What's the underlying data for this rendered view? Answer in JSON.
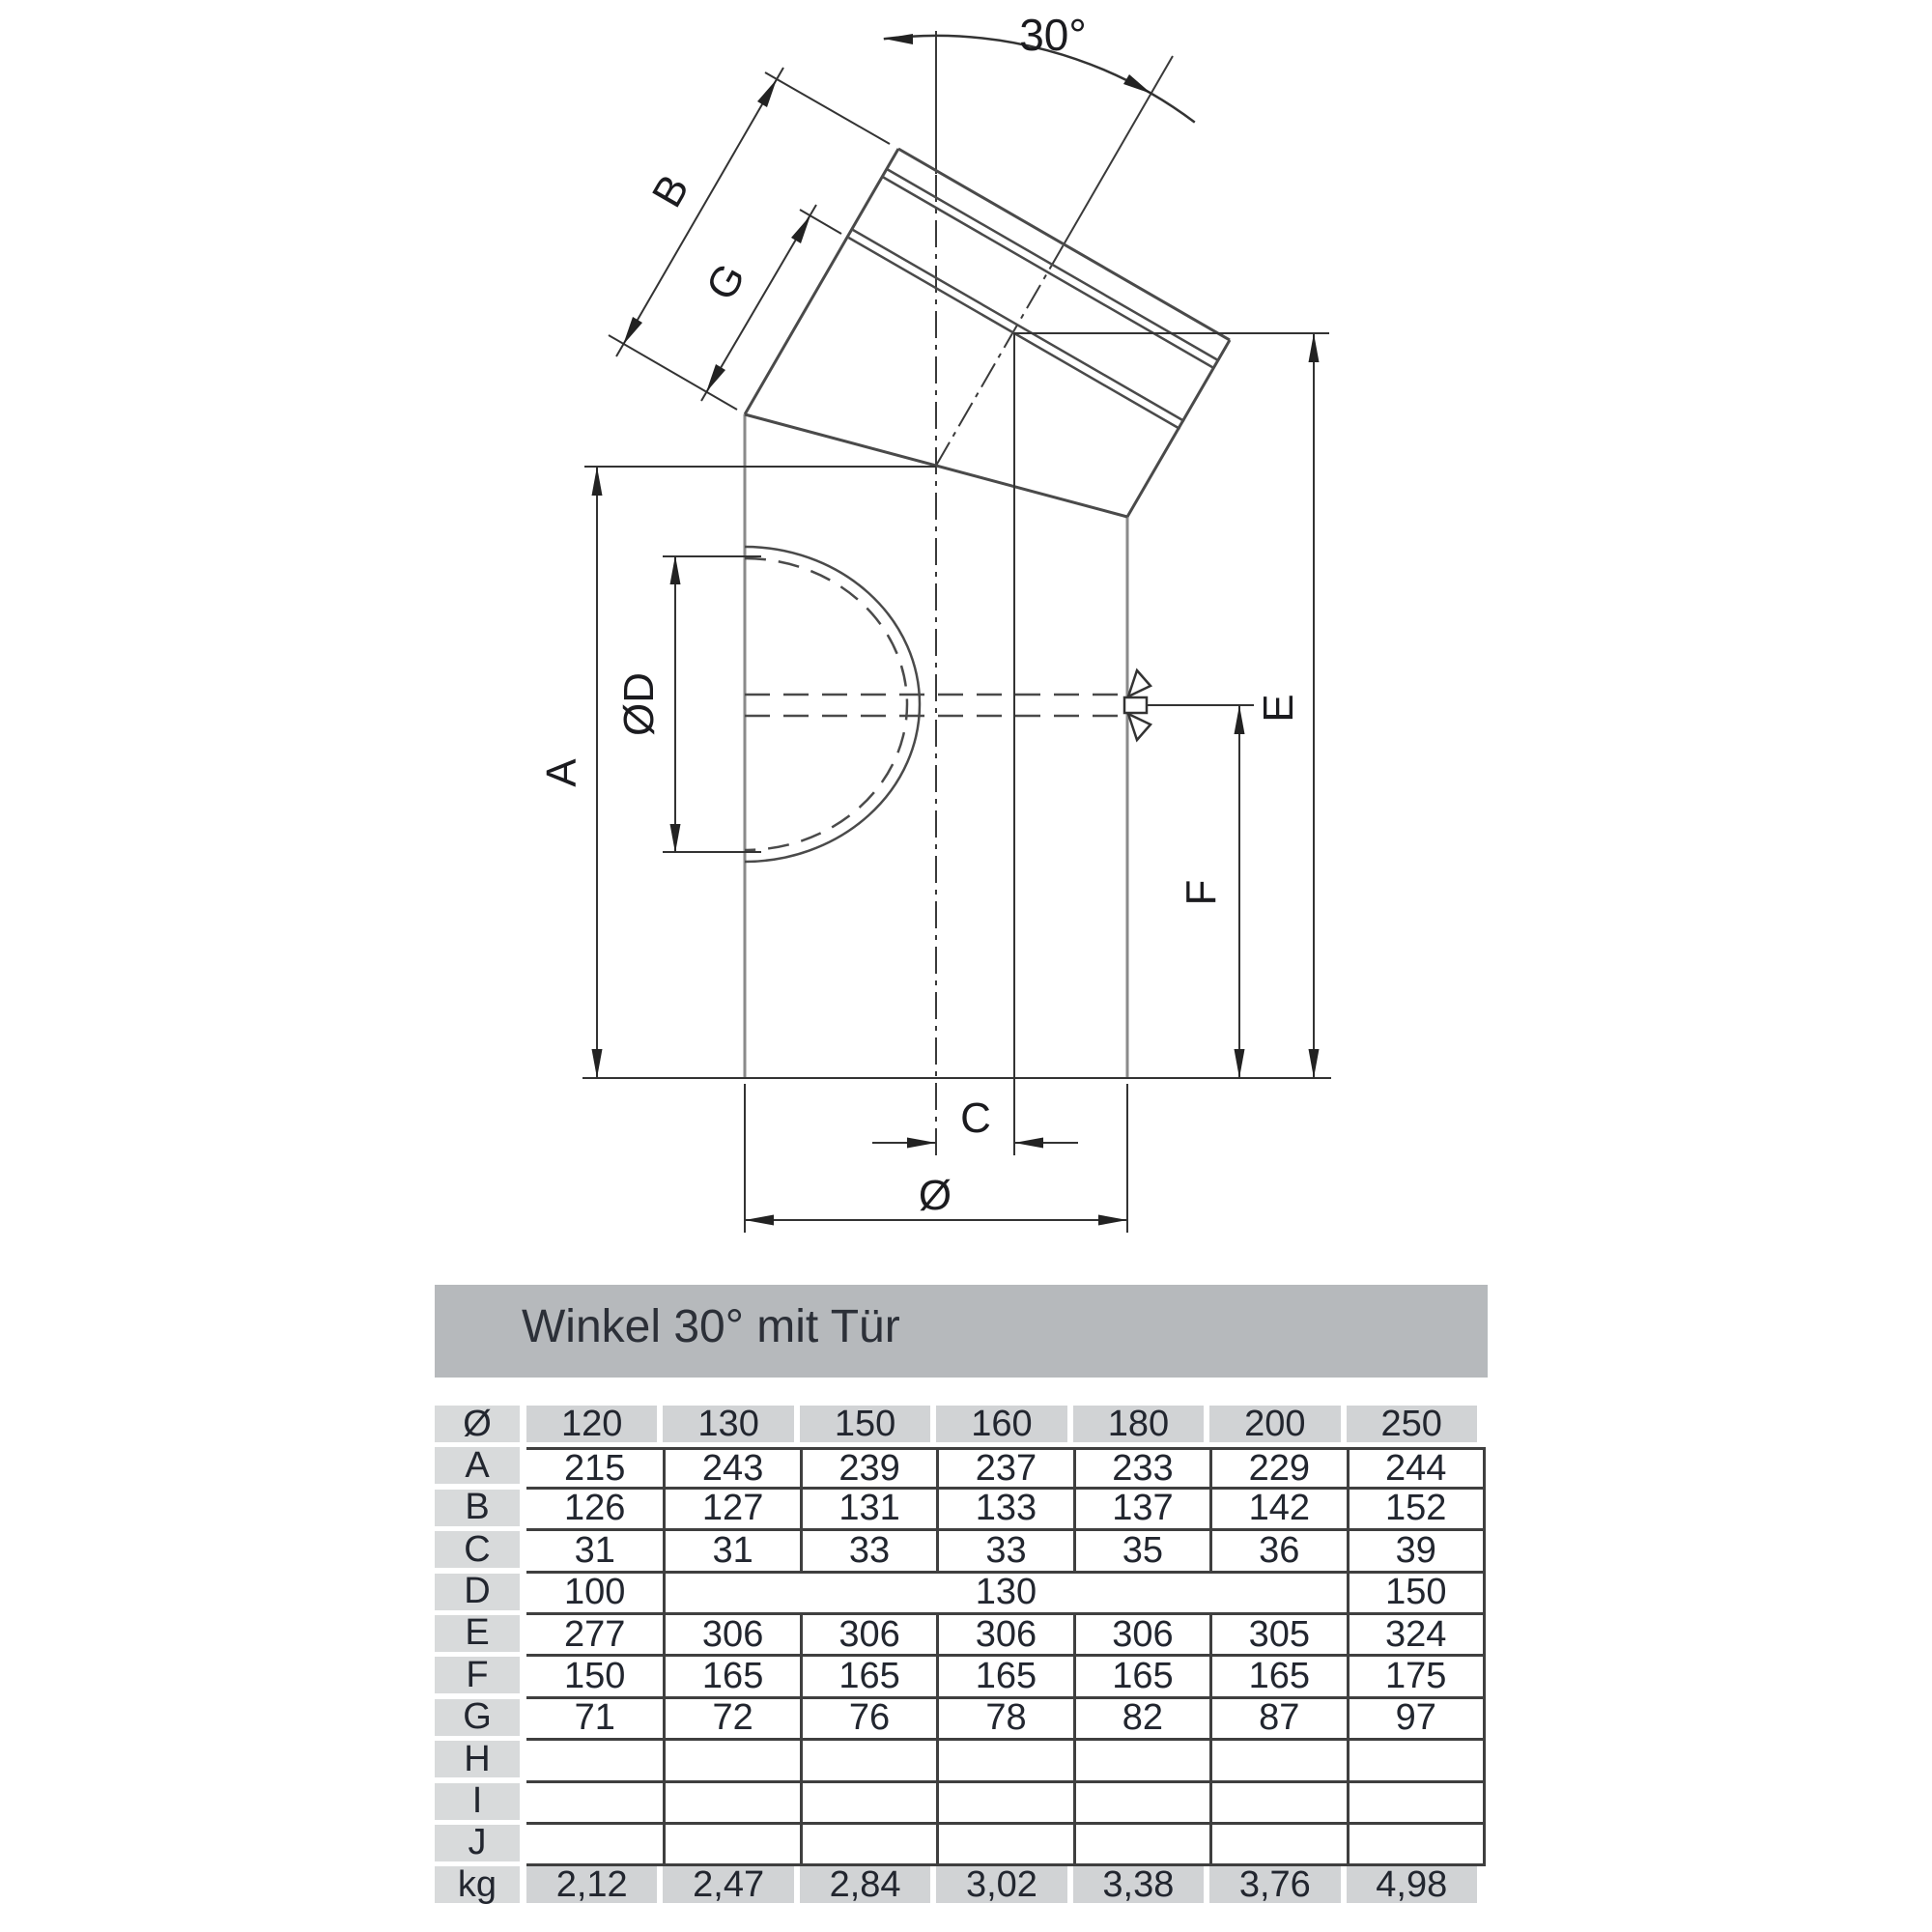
{
  "drawing": {
    "labels": {
      "angle": "30°",
      "b": "B",
      "g": "G",
      "a": "A",
      "door_diameter": "ØD",
      "e": "E",
      "f": "F",
      "c": "C",
      "diameter": "Ø"
    }
  },
  "table": {
    "title": "Winkel 30° mit Tür",
    "rows": [
      {
        "label": "Ø",
        "kind": "boxes",
        "cells": [
          {
            "v": "120"
          },
          {
            "v": "130"
          },
          {
            "v": "150"
          },
          {
            "v": "160"
          },
          {
            "v": "180"
          },
          {
            "v": "200"
          },
          {
            "v": "250"
          }
        ]
      },
      {
        "label": "A",
        "kind": "ruled",
        "top": true,
        "cells": [
          {
            "v": "215"
          },
          {
            "v": "243"
          },
          {
            "v": "239"
          },
          {
            "v": "237"
          },
          {
            "v": "233"
          },
          {
            "v": "229"
          },
          {
            "v": "244"
          }
        ]
      },
      {
        "label": "B",
        "kind": "ruled",
        "cells": [
          {
            "v": "126"
          },
          {
            "v": "127"
          },
          {
            "v": "131"
          },
          {
            "v": "133"
          },
          {
            "v": "137"
          },
          {
            "v": "142"
          },
          {
            "v": "152"
          }
        ]
      },
      {
        "label": "C",
        "kind": "ruled",
        "cells": [
          {
            "v": "31"
          },
          {
            "v": "31"
          },
          {
            "v": "33"
          },
          {
            "v": "33"
          },
          {
            "v": "35"
          },
          {
            "v": "36"
          },
          {
            "v": "39"
          }
        ]
      },
      {
        "label": "D",
        "kind": "ruled",
        "cells": [
          {
            "v": "100"
          },
          {
            "v": "130",
            "span": 5
          },
          {
            "v": "150"
          }
        ]
      },
      {
        "label": "E",
        "kind": "ruled",
        "cells": [
          {
            "v": "277"
          },
          {
            "v": "306"
          },
          {
            "v": "306"
          },
          {
            "v": "306"
          },
          {
            "v": "306"
          },
          {
            "v": "305"
          },
          {
            "v": "324"
          }
        ]
      },
      {
        "label": "F",
        "kind": "ruled",
        "cells": [
          {
            "v": "150"
          },
          {
            "v": "165"
          },
          {
            "v": "165"
          },
          {
            "v": "165"
          },
          {
            "v": "165"
          },
          {
            "v": "165"
          },
          {
            "v": "175"
          }
        ]
      },
      {
        "label": "G",
        "kind": "ruled",
        "cells": [
          {
            "v": "71"
          },
          {
            "v": "72"
          },
          {
            "v": "76"
          },
          {
            "v": "78"
          },
          {
            "v": "82"
          },
          {
            "v": "87"
          },
          {
            "v": "97"
          }
        ]
      },
      {
        "label": "H",
        "kind": "ruled",
        "cells": [
          {
            "v": ""
          },
          {
            "v": ""
          },
          {
            "v": ""
          },
          {
            "v": ""
          },
          {
            "v": ""
          },
          {
            "v": ""
          },
          {
            "v": ""
          }
        ]
      },
      {
        "label": "I",
        "kind": "ruled",
        "cells": [
          {
            "v": ""
          },
          {
            "v": ""
          },
          {
            "v": ""
          },
          {
            "v": ""
          },
          {
            "v": ""
          },
          {
            "v": ""
          },
          {
            "v": ""
          }
        ]
      },
      {
        "label": "J",
        "kind": "ruled",
        "cells": [
          {
            "v": ""
          },
          {
            "v": ""
          },
          {
            "v": ""
          },
          {
            "v": ""
          },
          {
            "v": ""
          },
          {
            "v": ""
          },
          {
            "v": ""
          }
        ]
      },
      {
        "label": "kg",
        "kind": "boxes",
        "cells": [
          {
            "v": "2,12"
          },
          {
            "v": "2,47"
          },
          {
            "v": "2,84"
          },
          {
            "v": "3,02"
          },
          {
            "v": "3,38"
          },
          {
            "v": "3,76"
          },
          {
            "v": "4,98"
          }
        ]
      }
    ]
  }
}
